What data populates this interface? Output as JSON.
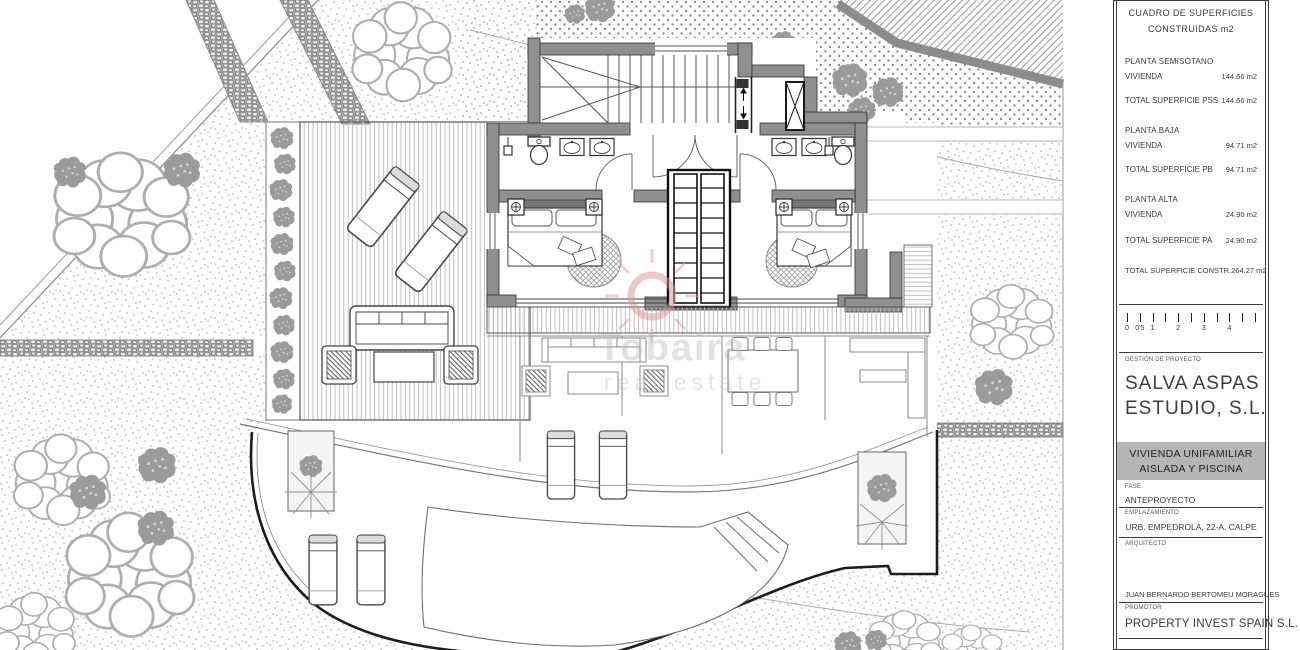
{
  "watermark": {
    "brand": "Tobaira",
    "tagline": "real estate"
  },
  "title_block": {
    "surfaces_header_1": "CUADRO DE SUPERFICIES",
    "surfaces_header_2": "CONSTRUIDAS m2",
    "sections": [
      {
        "title": "PLANTA SEMISÓTANO",
        "rows": [
          {
            "label": "VIVIENDA",
            "value": "144.66 m2"
          },
          {
            "label": "TOTAL SUPERFICIE PSS",
            "value": "144.66 m2"
          }
        ]
      },
      {
        "title": "PLANTA BAJA",
        "rows": [
          {
            "label": "VIVIENDA",
            "value": "94.71 m2"
          },
          {
            "label": "TOTAL SUPERFICIE PB",
            "value": "94.71 m2"
          }
        ]
      },
      {
        "title": "PLANTA ALTA",
        "rows": [
          {
            "label": "VIVIENDA",
            "value": "24.90 m2"
          },
          {
            "label": "TOTAL SUPERFICIE PA",
            "value": "24.90 m2"
          }
        ]
      }
    ],
    "total_row": {
      "label": "TOTAL SUPERFICIE CONSTR.",
      "value": "264.27 m2"
    },
    "scale_bar": {
      "labels": [
        "0",
        "0'5",
        "1",
        "2",
        "3",
        "4"
      ]
    },
    "gestion_label": "GESTIÓN DE PROYECTO",
    "studio_name_1": "SALVA ASPAS",
    "studio_name_2": "ESTUDIO, S.L.",
    "project_title_1": "VIVIENDA UNIFAMILIAR",
    "project_title_2": "AISLADA Y PISCINA",
    "fase_label": "FASE",
    "fase_value": "ANTEPROYECTO",
    "emplazamiento_label": "EMPLAZAMIENTO",
    "emplazamiento_value": "URB. EMPEDROLA, 22-A, CALPE",
    "arquitecto_label": "ARQUITECTO",
    "arquitecto_value": "JUAN BERNARDO BERTOMEU MORAGUES",
    "promotor_label": "PROMOTOR",
    "promotor_value": "PROPERTY INVEST SPAIN S.L."
  },
  "colors": {
    "wall_gray": "#8f8f8f",
    "band_gray": "#b5b5b5",
    "line_dark": "#2f2f2f",
    "watermark_red": "#d49090"
  }
}
